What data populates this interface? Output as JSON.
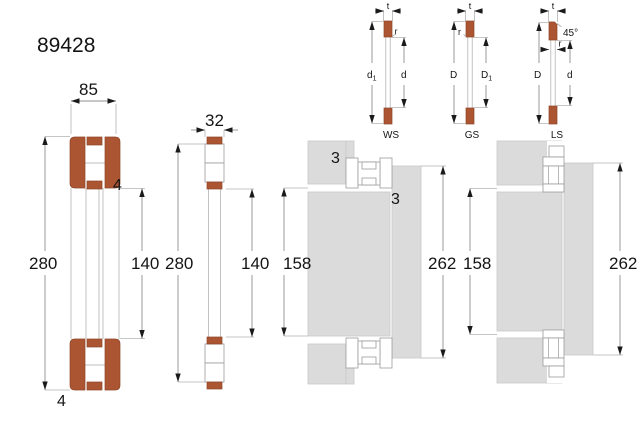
{
  "title": "89428",
  "colors": {
    "washer": "#AC5532",
    "gray": "#DBDBDB",
    "background": "#FFFFFF"
  },
  "main_view": {
    "width": "85",
    "outer": "280",
    "bore": "140",
    "step_top": "4",
    "step_bottom": "4"
  },
  "cage_view": {
    "width": "32",
    "outer": "280",
    "bore": "140"
  },
  "ws": {
    "label": "WS",
    "t": "t",
    "r": "r",
    "outer_main": "d",
    "outer_sub": "1",
    "bore": "d"
  },
  "gs": {
    "label": "GS",
    "t": "t",
    "r": "r",
    "outer": "D",
    "bore_main": "D",
    "bore_sub": "1"
  },
  "ls": {
    "label": "LS",
    "t": "t",
    "r": "r",
    "outer": "D",
    "bore": "d",
    "chamfer": "45°"
  },
  "mount_ws": {
    "shaft_seat": "158",
    "housing_seat": "262",
    "recess_width": "3",
    "recess_height": "3"
  },
  "mount_gs_ls": {
    "shaft_seat": "158",
    "housing_seat": "262"
  }
}
